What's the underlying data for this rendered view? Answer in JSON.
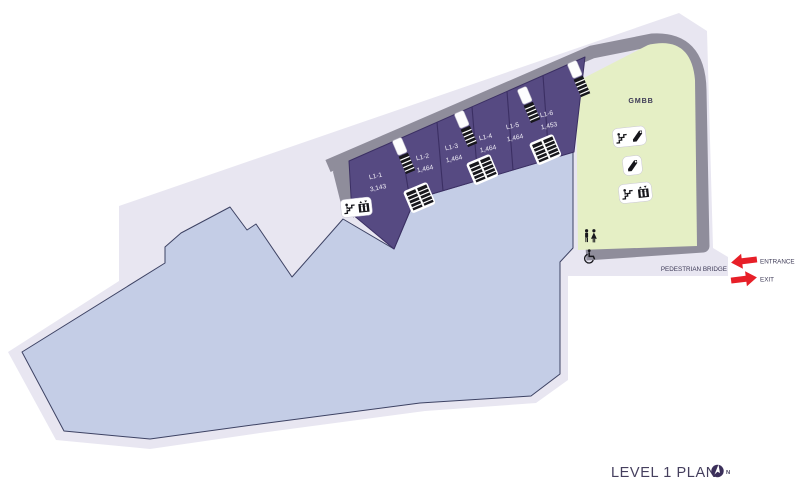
{
  "plan": {
    "title": "LEVEL 1 PLAN",
    "north_label": "N",
    "zones": {
      "gmbb": "GMBB",
      "pedestrian_bridge": "PEDESTRIAN BRIDGE"
    },
    "access": {
      "entrance": "ENTRANCE",
      "exit": "EXIT"
    },
    "units": [
      {
        "id": "L1-1",
        "area": "3,143"
      },
      {
        "id": "L1-2",
        "area": "1,464"
      },
      {
        "id": "L1-3",
        "area": "1,464"
      },
      {
        "id": "L1-4",
        "area": "1,464"
      },
      {
        "id": "L1-5",
        "area": "1,464"
      },
      {
        "id": "L1-6",
        "area": "1,453"
      }
    ],
    "icons": [
      "stairs-icon",
      "escalator-icon",
      "lift-icon",
      "toilet-icon",
      "wheelchair-icon",
      "staircase-plan-icon",
      "escalator-pair-plan-icon",
      "north-compass-icon",
      "entrance-arrow-icon",
      "exit-arrow-icon"
    ],
    "colors": {
      "site": "#e8e6f1",
      "floor": "#c4cde6",
      "floor-outline": "#3d4263",
      "retail": "#564a82",
      "retail-outline": "#3b2f63",
      "wall": "#8f8d9b",
      "gmbb": "#e5efc5",
      "arrow": "#e71f28",
      "ink": "#3d3a56",
      "title": "#453f5e",
      "unit-text": "#f2f0f8"
    }
  }
}
